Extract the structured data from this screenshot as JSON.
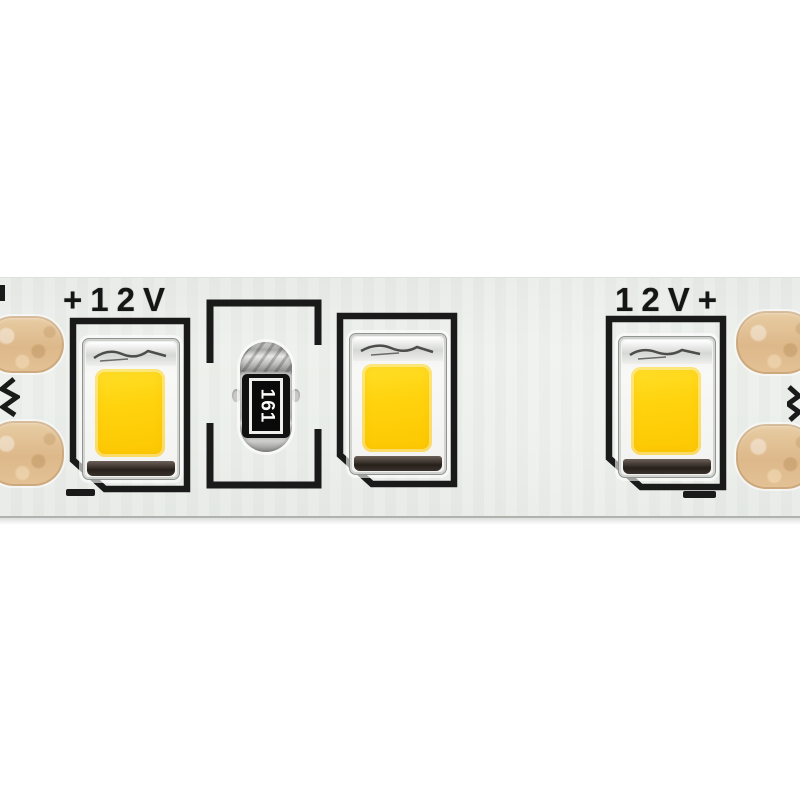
{
  "image": {
    "type": "close-up product photo",
    "subject": "12V SMD LED strip segment with three warm-white LEDs, a current-limiting resistor and copper solder pads",
    "background_color": "#ffffff"
  },
  "strip": {
    "pcb_color": "#eaede9",
    "silkscreen_color": "#151515",
    "left_label": "+12V",
    "right_label": "12V+",
    "resistor": {
      "code": "161",
      "body_color": "#b9b9b7",
      "code_color": "#ffffff"
    },
    "leds": [
      {
        "id": "led-1",
        "phosphor_color": "#ffd30e"
      },
      {
        "id": "led-2",
        "phosphor_color": "#ffd30e"
      },
      {
        "id": "led-3",
        "phosphor_color": "#ffd30e"
      }
    ],
    "pads": {
      "color": "#e0bd8e",
      "left_count": 2,
      "right_count": 2
    },
    "polarity_marks": {
      "left_minus": true,
      "right_minus": true
    }
  }
}
